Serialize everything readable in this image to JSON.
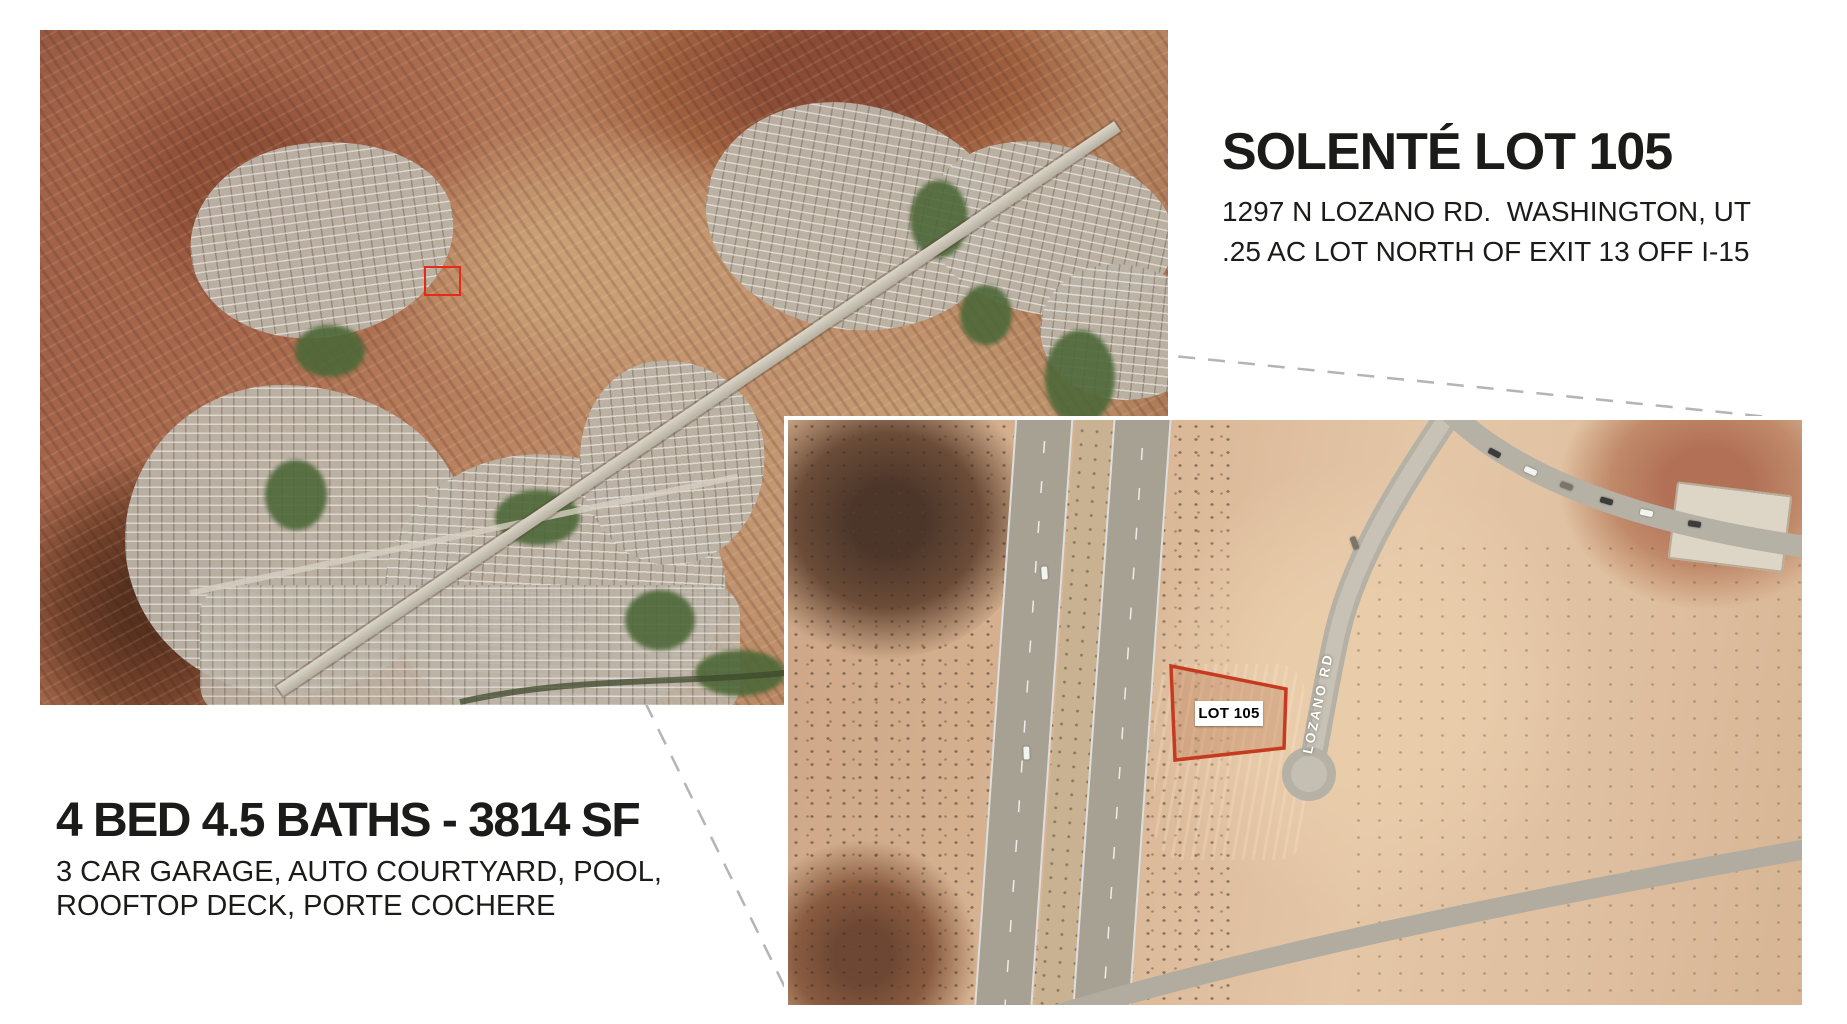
{
  "header": {
    "title": "SOLENTÉ LOT 105",
    "address": "1297 N LOZANO RD.  WASHINGTON, UT",
    "lot_info": ".25 AC LOT NORTH OF EXIT 13 OFF I-15"
  },
  "property_details": {
    "headline": "4 BED 4.5 BATHS - 3814 SF",
    "features_line_1": "3 CAR GARAGE, AUTO COURTYARD, POOL,",
    "features_line_2": "ROOFTOP DECK, PORTE COCHERE"
  },
  "detail_map": {
    "lot_label": "LOT 105",
    "road_label": "LOZANO RD"
  },
  "colors": {
    "lot_outline": "#c63a20",
    "overview_marker": "#e8291a",
    "connector_line": "#b4b4b4",
    "text": "#1b1b1a",
    "background": "#ffffff"
  }
}
